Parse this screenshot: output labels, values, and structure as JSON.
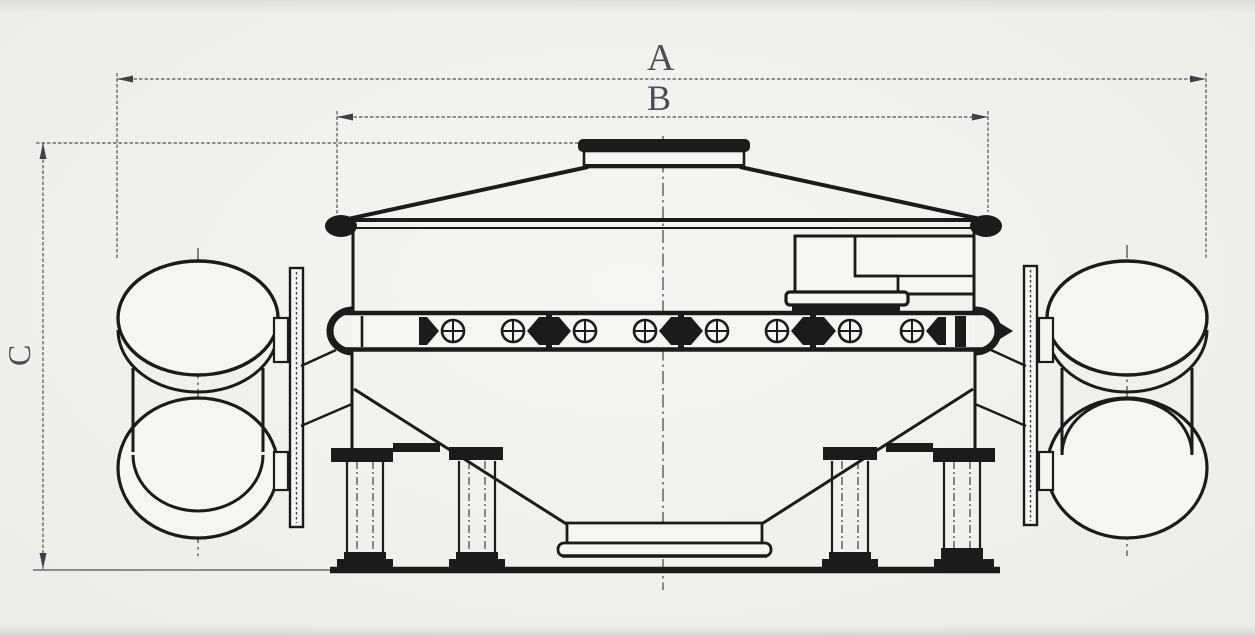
{
  "diagram": {
    "kind": "engineering dimension drawing of a vibrating sieve machine, side elevation",
    "labels": {
      "dim_a": "A",
      "dim_b": "B",
      "dim_c": "C"
    },
    "colors": {
      "paper": "#f1f0ec",
      "ink": "#1b1b1b",
      "dimension_line": "#4f545c",
      "label_text": "#4b4e54"
    }
  }
}
